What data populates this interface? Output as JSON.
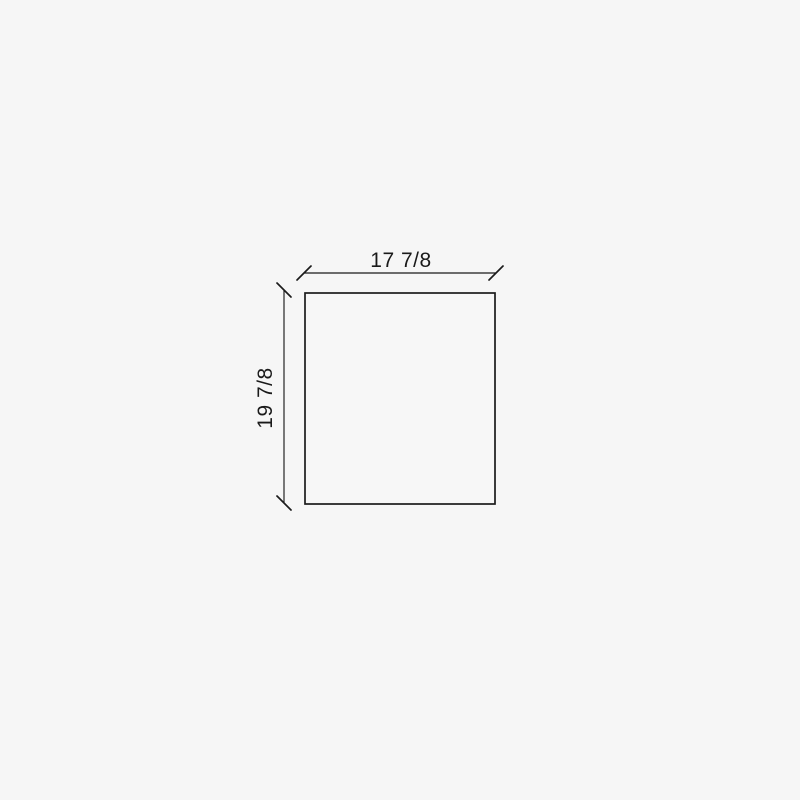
{
  "page": {
    "background_color": "#f6f6f6",
    "line_color": "#1b1b1b",
    "text_color": "#1a1a1a"
  },
  "diagram": {
    "type": "dimension-drawing",
    "shape": "rectangle",
    "width_label": "17 7/8",
    "height_label": "19 7/8"
  }
}
